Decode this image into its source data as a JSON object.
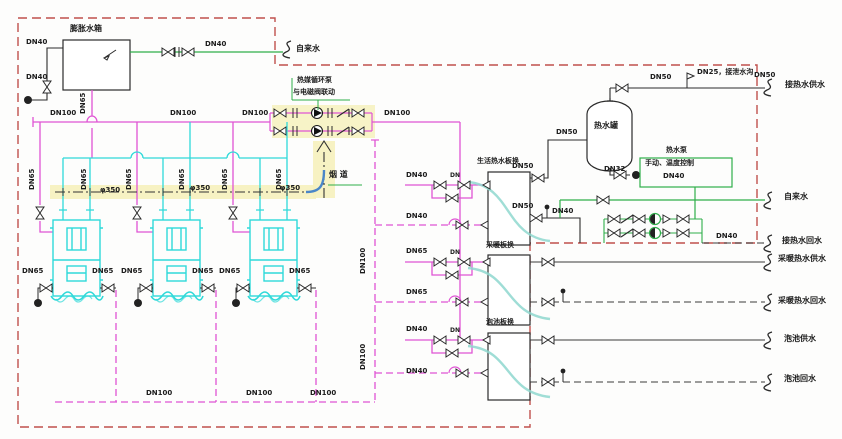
{
  "colors": {
    "supply_pipe": "#e054d4",
    "boiler_body": "#2fd9d9",
    "tap_water": "#2fae4a",
    "flue_highlight": "#f6f1bd",
    "boundary": "#c0504d",
    "flue_elbow": "#4a86c8",
    "symbol": "#2b2b2b"
  },
  "labels": [
    {
      "t": "膨胀水箱",
      "x": 70,
      "y": 25,
      "cn": 1,
      "n": "expansion-tank-label"
    },
    {
      "t": "DN40",
      "x": 26,
      "y": 39
    },
    {
      "t": "DN40",
      "x": 26,
      "y": 74
    },
    {
      "t": "DN40",
      "x": 205,
      "y": 41
    },
    {
      "t": "自来水",
      "x": 296,
      "y": 45,
      "cn": 1,
      "n": "tap-water-inlet-label"
    },
    {
      "t": "DN65",
      "x": 80,
      "y": 114,
      "r": -90
    },
    {
      "t": "DN100",
      "x": 50,
      "y": 110
    },
    {
      "t": "DN100",
      "x": 170,
      "y": 110
    },
    {
      "t": "DN100",
      "x": 242,
      "y": 110
    },
    {
      "t": "DN100",
      "x": 384,
      "y": 110
    },
    {
      "t": "热媒循环泵",
      "x": 297,
      "y": 77,
      "n": "circulation-pump-label"
    },
    {
      "t": "与电磁阀联动",
      "x": 293,
      "y": 89
    },
    {
      "t": "烟 道",
      "x": 329,
      "y": 171,
      "cn": 1,
      "n": "flue-label"
    },
    {
      "t": "DN65",
      "x": 29,
      "y": 190,
      "r": -90
    },
    {
      "t": "DN65",
      "x": 81,
      "y": 190,
      "r": -90
    },
    {
      "t": "DN65",
      "x": 126,
      "y": 190,
      "r": -90
    },
    {
      "t": "DN65",
      "x": 179,
      "y": 190,
      "r": -90
    },
    {
      "t": "DN65",
      "x": 222,
      "y": 190,
      "r": -90
    },
    {
      "t": "DN65",
      "x": 276,
      "y": 190,
      "r": -90
    },
    {
      "t": "φ350",
      "x": 100,
      "y": 187
    },
    {
      "t": "φ350",
      "x": 190,
      "y": 185
    },
    {
      "t": "φ350",
      "x": 280,
      "y": 185
    },
    {
      "t": "DN65",
      "x": 22,
      "y": 268
    },
    {
      "t": "DN65",
      "x": 92,
      "y": 268
    },
    {
      "t": "DN65",
      "x": 121,
      "y": 268
    },
    {
      "t": "DN65",
      "x": 192,
      "y": 268
    },
    {
      "t": "DN65",
      "x": 219,
      "y": 268
    },
    {
      "t": "DN65",
      "x": 289,
      "y": 268
    },
    {
      "t": "DN100",
      "x": 146,
      "y": 390
    },
    {
      "t": "DN100",
      "x": 246,
      "y": 390
    },
    {
      "t": "DN100",
      "x": 310,
      "y": 390
    },
    {
      "t": "DN100",
      "x": 360,
      "y": 274,
      "r": -90
    },
    {
      "t": "DN100",
      "x": 360,
      "y": 370,
      "r": -90
    },
    {
      "t": "DN40",
      "x": 406,
      "y": 172
    },
    {
      "t": "DN40",
      "x": 406,
      "y": 213
    },
    {
      "t": "DN65",
      "x": 406,
      "y": 248
    },
    {
      "t": "DN65",
      "x": 406,
      "y": 289
    },
    {
      "t": "DN40",
      "x": 406,
      "y": 326
    },
    {
      "t": "DN40",
      "x": 406,
      "y": 368
    },
    {
      "t": "生活热水板换",
      "x": 477,
      "y": 158,
      "n": "dhw-exchanger-label"
    },
    {
      "t": "采暖板换",
      "x": 486,
      "y": 242,
      "n": "heating-exchanger-label"
    },
    {
      "t": "泡池板换",
      "x": 486,
      "y": 319,
      "n": "pool-exchanger-label"
    },
    {
      "t": "DN",
      "x": 450,
      "y": 173,
      "fs": 6
    },
    {
      "t": "DN",
      "x": 450,
      "y": 250,
      "fs": 6
    },
    {
      "t": "DN",
      "x": 450,
      "y": 328,
      "fs": 6
    },
    {
      "t": "DN50",
      "x": 512,
      "y": 163
    },
    {
      "t": "DN50",
      "x": 556,
      "y": 129
    },
    {
      "t": "DN50",
      "x": 512,
      "y": 203
    },
    {
      "t": "DN40",
      "x": 552,
      "y": 208
    },
    {
      "t": "DN50",
      "x": 650,
      "y": 74
    },
    {
      "t": "DN25，接泄水沟",
      "x": 697,
      "y": 69
    },
    {
      "t": "DN50",
      "x": 754,
      "y": 72
    },
    {
      "t": "接热水供水",
      "x": 785,
      "y": 81,
      "cn": 1,
      "n": "hw-supply-outlet-label"
    },
    {
      "t": "热水罐",
      "x": 594,
      "y": 122,
      "cn": 1,
      "n": "hot-water-tank-label"
    },
    {
      "t": "DN32",
      "x": 604,
      "y": 166
    },
    {
      "t": "热水泵",
      "x": 666,
      "y": 147,
      "n": "makeup-pump-label"
    },
    {
      "t": "手动、温度控制",
      "x": 645,
      "y": 160
    },
    {
      "t": "DN40",
      "x": 663,
      "y": 173
    },
    {
      "t": "自来水",
      "x": 784,
      "y": 193,
      "cn": 1,
      "n": "tap-water-outlet-label"
    },
    {
      "t": "DN40",
      "x": 716,
      "y": 233
    },
    {
      "t": "接热水回水",
      "x": 782,
      "y": 237,
      "cn": 1,
      "n": "hw-return-label"
    },
    {
      "t": "采暖热水供水",
      "x": 778,
      "y": 255,
      "cn": 1,
      "n": "heating-supply-label"
    },
    {
      "t": "采暖热水回水",
      "x": 778,
      "y": 297,
      "cn": 1,
      "n": "heating-return-label"
    },
    {
      "t": "泡池供水",
      "x": 784,
      "y": 335,
      "cn": 1,
      "n": "pool-supply-label"
    },
    {
      "t": "泡池回水",
      "x": 784,
      "y": 375,
      "cn": 1,
      "n": "pool-return-label"
    }
  ]
}
